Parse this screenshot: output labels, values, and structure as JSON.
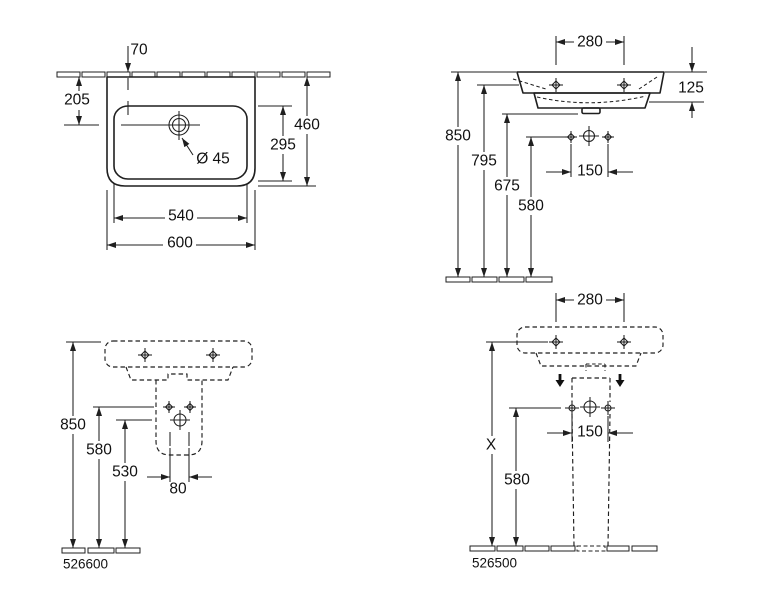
{
  "meta": {
    "background_color": "#ffffff",
    "line_color": "#1f1f1f",
    "bold_arrow_color": "#111111"
  },
  "plan": {
    "d70": "70",
    "d205": "205",
    "d460": "460",
    "d295": "295",
    "d540": "540",
    "d600": "600",
    "dia45": "Ø 45"
  },
  "side": {
    "d280": "280",
    "d125": "125",
    "d850": "850",
    "d795": "795",
    "d675": "675",
    "d580": "580",
    "d150": "150"
  },
  "half_pedestal": {
    "d850": "850",
    "d580": "580",
    "d530": "530",
    "d80": "80",
    "product": "526600"
  },
  "pedestal": {
    "d280": "280",
    "dX": "X",
    "d580": "580",
    "d150": "150",
    "product": "526500"
  }
}
